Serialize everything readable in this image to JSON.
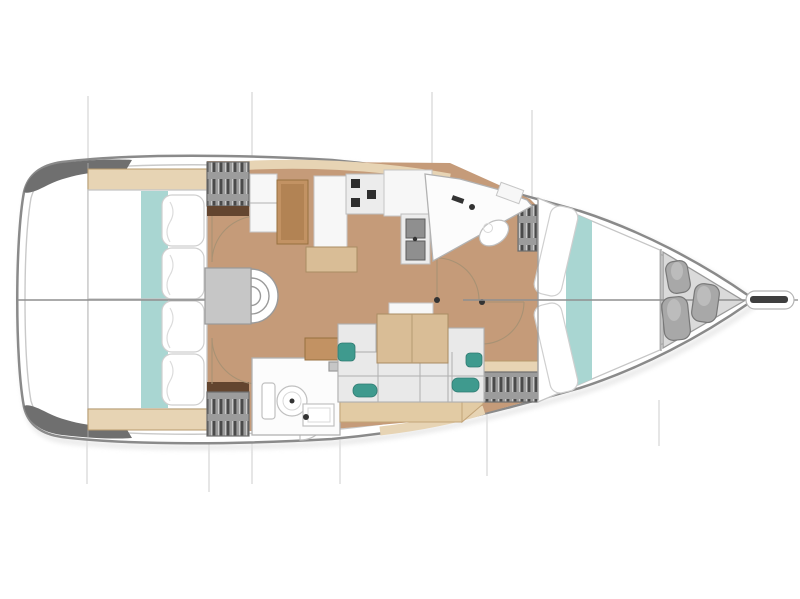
{
  "plan": {
    "type": "yacht-interior-floor-plan",
    "view": "top-down",
    "orientation": "bow-right",
    "rooms": [
      {
        "id": "aft-cabin-top",
        "name": "Aft double cabin (upper side)"
      },
      {
        "id": "aft-cabin-bottom",
        "name": "Aft double cabin (lower side)"
      },
      {
        "id": "companionway",
        "name": "Companionway landing with curved steps"
      },
      {
        "id": "nav-station",
        "name": "Chart table with seat"
      },
      {
        "id": "galley",
        "name": "Galley with stove and double sink"
      },
      {
        "id": "salon",
        "name": "Salon with sofa and folding table"
      },
      {
        "id": "head-aft",
        "name": "Aft head with toilet and sink"
      },
      {
        "id": "head-forward",
        "name": "Forward head with sink and toilet"
      },
      {
        "id": "forward-cabin",
        "name": "Forward V-berth cabin"
      },
      {
        "id": "bow-locker",
        "name": "Bow locker with fenders"
      }
    ],
    "counts": {
      "berths": 3,
      "heads": 2,
      "companionway_steps": 3,
      "stove_burners": 3,
      "galley_sinks": 2,
      "bow_fenders": 3,
      "deck_gratings": 4,
      "station_lines_top": 4,
      "station_lines_bottom": 6
    }
  },
  "colors": {
    "hull-stroke": "#8a8a8a",
    "hull-inner": "#c9c9c9",
    "deck-dark": "#6f6f6f",
    "floor": "#c59b79",
    "wood-light": "#e7d4b4",
    "wood-mid": "#d9bd96",
    "wood-desk": "#c29263",
    "wood-trim": "#b79a6c",
    "wood-plinth": "#e2cba4",
    "teal": "#a9d6d2",
    "teal-dark": "#3f9a8e",
    "gray-box": "#c6c6c6",
    "grate-bg": "#9c9c9c",
    "grate-bar": "#4a4a4a",
    "brown-dark": "#63452f",
    "fixture-stroke": "#c0c0c0",
    "white-fur": "#f7f7f7",
    "sofa": "#e9e9e9",
    "sofa-stroke": "#b0b0b0",
    "burner": "#2e2e2e",
    "sink-dark": "#8f8f8f",
    "fender": "#a8a8a8",
    "fender-stroke": "#787878",
    "locker": "#dadada",
    "station": "#cccccc",
    "centerline": "#8f8f8f",
    "door-arc": "#a89274",
    "bed-stroke": "#c5c5c5",
    "bowsprit-dark": "#3f3f3f",
    "shadow": "#e3e3e3"
  }
}
